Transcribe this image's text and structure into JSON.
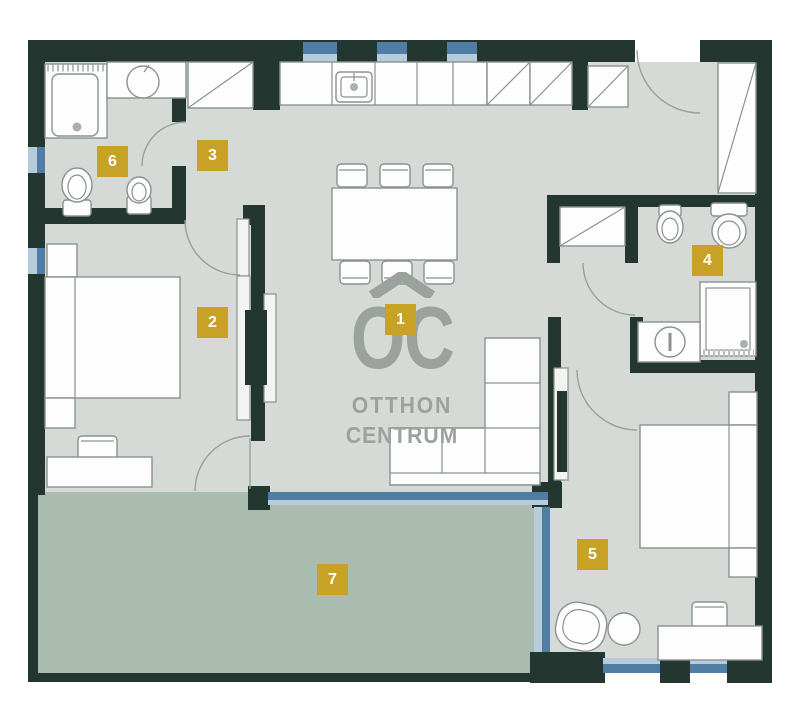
{
  "brand": {
    "logo_acronym": "OC",
    "logo_word1": "OTTHON",
    "logo_word2": "CENTRUM"
  },
  "colors": {
    "wall": "#243630",
    "floor": "#D5DAD6",
    "terrace": "#A9BCAF",
    "glazing": "#4F7DA3",
    "glazing_light": "#B7CBDB",
    "marker": "#C7A227",
    "logo": "#9BA29E",
    "line": "#8A928E"
  },
  "floor_plan": {
    "room_markers": [
      {
        "number": "1",
        "x": 385,
        "y": 304
      },
      {
        "number": "2",
        "x": 197,
        "y": 307
      },
      {
        "number": "3",
        "x": 197,
        "y": 140
      },
      {
        "number": "4",
        "x": 692,
        "y": 245
      },
      {
        "number": "5",
        "x": 577,
        "y": 539
      },
      {
        "number": "6",
        "x": 97,
        "y": 146
      },
      {
        "number": "7",
        "x": 317,
        "y": 564
      }
    ]
  }
}
